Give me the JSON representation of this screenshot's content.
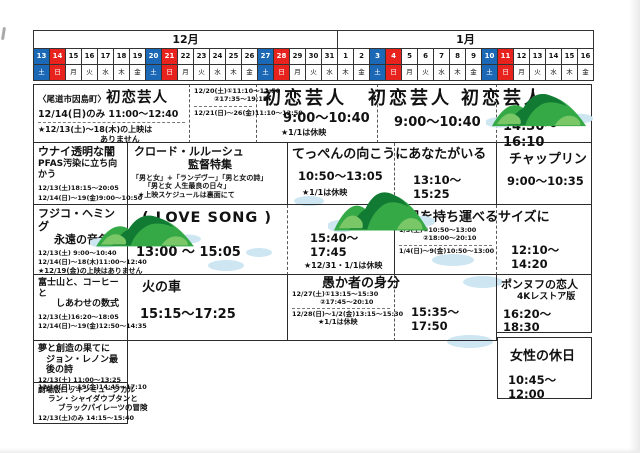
{
  "page": {
    "width": 640,
    "height": 453
  },
  "colors": {
    "saturday": "#1b69b6",
    "sunday": "#e8231d",
    "ink": "#111111",
    "grid_line": "#2b2b2b",
    "cloud": "#cde6f2",
    "island_green": "#35a946",
    "island_dark": "#117a33",
    "island_light": "#7ac768"
  },
  "calendar": {
    "months": [
      {
        "label": "12月",
        "days": 19
      },
      {
        "label": "1月",
        "days": 16
      }
    ],
    "days": [
      {
        "d": "13",
        "w": "土",
        "t": "sat"
      },
      {
        "d": "14",
        "w": "日",
        "t": "sun"
      },
      {
        "d": "15",
        "w": "月"
      },
      {
        "d": "16",
        "w": "火"
      },
      {
        "d": "17",
        "w": "水"
      },
      {
        "d": "18",
        "w": "木"
      },
      {
        "d": "19",
        "w": "金"
      },
      {
        "d": "20",
        "w": "土",
        "t": "sat"
      },
      {
        "d": "21",
        "w": "日",
        "t": "sun"
      },
      {
        "d": "22",
        "w": "月"
      },
      {
        "d": "23",
        "w": "火"
      },
      {
        "d": "24",
        "w": "水"
      },
      {
        "d": "25",
        "w": "木"
      },
      {
        "d": "26",
        "w": "金"
      },
      {
        "d": "27",
        "w": "土",
        "t": "sat"
      },
      {
        "d": "28",
        "w": "日",
        "t": "sun"
      },
      {
        "d": "29",
        "w": "月"
      },
      {
        "d": "30",
        "w": "火"
      },
      {
        "d": "31",
        "w": "水"
      },
      {
        "d": "1",
        "w": "木"
      },
      {
        "d": "2",
        "w": "金"
      },
      {
        "d": "3",
        "w": "土",
        "t": "sat"
      },
      {
        "d": "4",
        "w": "日",
        "t": "sun"
      },
      {
        "d": "5",
        "w": "月"
      },
      {
        "d": "6",
        "w": "火"
      },
      {
        "d": "7",
        "w": "水"
      },
      {
        "d": "8",
        "w": "木"
      },
      {
        "d": "9",
        "w": "金"
      },
      {
        "d": "10",
        "w": "土",
        "t": "sat"
      },
      {
        "d": "11",
        "w": "日",
        "t": "sun"
      },
      {
        "d": "12",
        "w": "月"
      },
      {
        "d": "13",
        "w": "火"
      },
      {
        "d": "14",
        "w": "水"
      },
      {
        "d": "15",
        "w": "木"
      },
      {
        "d": "16",
        "w": "金"
      }
    ]
  },
  "cells": [
    {
      "id": "cell-hatsukoi-onomichi",
      "x": 33,
      "y": 84,
      "w": 157,
      "h": 59,
      "b": "sdss",
      "lines": [
        {
          "parts": [
            {
              "t": "〈尾道市因島町〉",
              "cls": "ttl-xs"
            },
            {
              "t": "初恋芸人",
              "cls": "ttl-lg"
            }
          ]
        },
        {
          "t": "12/14(日)のみ 11:00～12:40",
          "cls": "time-sm",
          "mt": 2
        },
        {
          "div": 1,
          "mt": 2
        },
        {
          "t": "★12/13(土)～18(木)の上映は",
          "cls": "note",
          "mt": 2
        },
        {
          "t": "ありません",
          "cls": "note",
          "ml": 62
        }
      ]
    },
    {
      "id": "cell-hatsukoi-week2",
      "x": 190,
      "y": 84,
      "w": 67,
      "h": 59,
      "b": "sdsn",
      "lines": [
        {
          "t": "12/20(土)①11:10～12:50",
          "cls": "time-xxs"
        },
        {
          "t": "②17:35～19:15",
          "cls": "time-xxs",
          "ml": 20
        },
        {
          "div": 1,
          "mt": 3
        },
        {
          "t": "12/21(日)～26(金)11:10～12:50",
          "cls": "time-xxs",
          "mt": 3
        }
      ]
    },
    {
      "id": "cell-hatsukoi-week3",
      "x": 257,
      "y": 84,
      "w": 121,
      "h": 59,
      "b": "sdsn",
      "lines": [
        {
          "t": "初恋芸人",
          "cls": "ttl-xl",
          "ml": 2
        },
        {
          "t": "9:00～10:40",
          "cls": "time-lg",
          "ml": 22,
          "mt": 2
        },
        {
          "t": "★1/1は休映",
          "cls": "note",
          "ml": 20,
          "mt": 1
        }
      ]
    },
    {
      "id": "cell-hatsukoi-week4",
      "x": 378,
      "y": 84,
      "w": 119,
      "h": 59,
      "b": "sdsn",
      "lines": [
        {
          "t": "初恋芸人",
          "cls": "ttl-xl",
          "ml": -14,
          "nw": 1
        },
        {
          "t": "9:00～10:40",
          "cls": "time-lg",
          "ml": 12,
          "mt": 6
        }
      ]
    },
    {
      "id": "cell-hatsukoi-week5",
      "x": 497,
      "y": 84,
      "w": 95,
      "h": 59,
      "b": "sssn",
      "lines": [
        {
          "t": "初恋芸人",
          "cls": "ttl-xl",
          "ml": -40,
          "nw": 1
        },
        {
          "t": "14:30～16:10",
          "cls": "time-lg",
          "mt": 10,
          "ml": 2
        }
      ]
    },
    {
      "id": "cell-unai-pfas",
      "x": 33,
      "y": 143,
      "w": 95,
      "h": 62,
      "b": "nsss",
      "lines": [
        {
          "t": "ウナイ透明な闇",
          "cls": "ttl-sm"
        },
        {
          "t": "PFAS汚染に立ち向かう",
          "cls": "ttl-xs2"
        },
        {
          "t": "12/13(土)18:15～20:05",
          "cls": "time-xxs",
          "mt": 5
        },
        {
          "t": "12/14(日)～19(金)9:00～10:50",
          "cls": "time-xxs",
          "mt": 2
        }
      ]
    },
    {
      "id": "cell-lelouch-tokushu",
      "x": 128,
      "y": 143,
      "w": 160,
      "h": 62,
      "b": "nssn",
      "lines": [
        {
          "t": "クロード・ルルーシュ",
          "cls": "ttl-sm",
          "ml": 2
        },
        {
          "t": "監督特集",
          "cls": "ttl-sm",
          "ml": 56
        },
        {
          "t": "「男と女」+「ランデヴー」「男と女の詩」",
          "cls": "small",
          "mt": 2
        },
        {
          "t": "「男と女 人生最良の日々」",
          "cls": "small",
          "ml": 12
        },
        {
          "t": "★上映スケジュールは裏面にて",
          "cls": "small",
          "ml": 6,
          "mt": 1
        }
      ]
    },
    {
      "id": "cell-teppen-1",
      "x": 288,
      "y": 143,
      "w": 107,
      "h": 62,
      "b": "ndsn",
      "lines": [
        {
          "t": "てっぺんの向こうにあなたがいる",
          "cls": "ttl-md",
          "nw": 1,
          "mt": 1
        },
        {
          "t": "10:50～13:05",
          "cls": "time-md",
          "mt": 8,
          "ml": 6
        },
        {
          "t": "★1/1は休映",
          "cls": "note",
          "mt": 4,
          "ml": 10
        }
      ]
    },
    {
      "id": "cell-teppen-2",
      "x": 395,
      "y": 143,
      "w": 102,
      "h": 62,
      "b": "nssn",
      "lines": [
        {
          "t": "13:10～15:25",
          "cls": "time-md",
          "mt": 28,
          "ml": 14
        }
      ]
    },
    {
      "id": "cell-chaplin",
      "x": 497,
      "y": 143,
      "w": 95,
      "h": 62,
      "b": "nssn",
      "lines": [
        {
          "t": "チャップリン",
          "cls": "ttl-md",
          "mt": 6,
          "ml": 8
        },
        {
          "t": "9:00～10:35",
          "cls": "time-md",
          "mt": 8,
          "ml": 6
        }
      ]
    },
    {
      "id": "cell-fujiko-hemming",
      "x": 33,
      "y": 205,
      "w": 95,
      "h": 70,
      "b": "nsss",
      "lines": [
        {
          "t": "フジコ・ヘミング",
          "cls": "ttl-sm"
        },
        {
          "t": "永遠の音色",
          "cls": "ttl-sm",
          "ml": 16
        },
        {
          "t": "12/13(土) 9:00～10:40",
          "cls": "time-xxs",
          "mt": 3
        },
        {
          "t": "12/14(日)～18(木)11:00～12:40",
          "cls": "time-xxs",
          "mt": 1
        },
        {
          "t": "★12/19(金)の上映はありません",
          "cls": "small",
          "mt": 1
        }
      ]
    },
    {
      "id": "cell-lovesong-1",
      "x": 128,
      "y": 205,
      "w": 160,
      "h": 70,
      "b": "ndsn",
      "lines": [
        {
          "t": "( LOVE SONG )",
          "cls": "ttl-lg",
          "ml": 10,
          "mt": 2
        },
        {
          "t": "13:00 ～ 15:05",
          "cls": "time-lg",
          "mt": 18,
          "ml": 4
        }
      ]
    },
    {
      "id": "cell-lovesong-2",
      "x": 288,
      "y": 205,
      "w": 107,
      "h": 70,
      "b": "nssn",
      "lines": [
        {
          "t": "15:40～17:45",
          "cls": "time-md",
          "mt": 24,
          "ml": 18
        },
        {
          "t": "★12/31・1/1は休映",
          "cls": "note",
          "ml": 12,
          "mt": 2
        }
      ]
    },
    {
      "id": "cell-ani-size-1",
      "x": 395,
      "y": 205,
      "w": 102,
      "h": 70,
      "b": "ndsn",
      "lines": [
        {
          "t": "兄を持ち運べるサイズに",
          "cls": "ttl-md",
          "nw": 1,
          "mt": 2,
          "ml": 8
        },
        {
          "t": "1/3(土)①10:50～13:00",
          "cls": "time-xxs",
          "mt": 2
        },
        {
          "t": "②18:00～20:10",
          "cls": "time-xxs",
          "ml": 24
        },
        {
          "div": 1,
          "mt": 2
        },
        {
          "t": "1/4(日)～9(金)10:50～13:00",
          "cls": "time-xxs",
          "mt": 2
        }
      ]
    },
    {
      "id": "cell-ani-size-2",
      "x": 497,
      "y": 205,
      "w": 95,
      "h": 70,
      "b": "nssn",
      "lines": [
        {
          "t": "12:10～14:20",
          "cls": "time-md",
          "mt": 36,
          "ml": 10
        }
      ]
    },
    {
      "id": "cell-fujisan-coffee",
      "x": 33,
      "y": 275,
      "w": 95,
      "h": 66,
      "b": "nsss",
      "lines": [
        {
          "t": "富士山と、コーヒーと",
          "cls": "ttl-xs2"
        },
        {
          "t": "しあわせの数式",
          "cls": "ttl-xs2",
          "ml": 18
        },
        {
          "t": "12/13(土)16:20～18:05",
          "cls": "time-xxs",
          "mt": 4
        },
        {
          "t": "12/14(日)～19(金)12:50～14:35",
          "cls": "time-xxs",
          "mt": 2
        }
      ]
    },
    {
      "id": "cell-hinokuruma",
      "x": 128,
      "y": 275,
      "w": 160,
      "h": 66,
      "b": "nssn",
      "lines": [
        {
          "t": "火の車",
          "cls": "ttl-md",
          "ml": 10,
          "mt": 2
        },
        {
          "t": "15:15～17:25",
          "cls": "time-lg",
          "mt": 12,
          "ml": 8
        }
      ]
    },
    {
      "id": "cell-orokamono-1",
      "x": 288,
      "y": 275,
      "w": 107,
      "h": 66,
      "b": "ndsn",
      "lines": [
        {
          "t": "愚か者の身分",
          "cls": "ttl-md",
          "nw": 1,
          "ml": 30,
          "mt": -2
        },
        {
          "t": "12/27(土)①13:15～15:30",
          "cls": "time-xxs"
        },
        {
          "t": "②17:45～20:10",
          "cls": "time-xxs",
          "ml": 28
        },
        {
          "div": 1,
          "mt": 1
        },
        {
          "t": "12/28(日)～1/2(金)13:15～15:30",
          "cls": "time-xxs",
          "mt": 1
        },
        {
          "t": "★1/1は休映",
          "cls": "small",
          "ml": 26
        }
      ]
    },
    {
      "id": "cell-orokamono-2",
      "x": 395,
      "y": 275,
      "w": 102,
      "h": 66,
      "b": "nssn",
      "lines": [
        {
          "t": "15:35～17:50",
          "cls": "time-md",
          "mt": 28,
          "ml": 12
        }
      ]
    },
    {
      "id": "cell-pont-neuf",
      "x": 497,
      "y": 275,
      "w": 95,
      "h": 58,
      "b": "nssn",
      "lines": [
        {
          "t": "ポンヌフの恋人",
          "cls": "ttl-sm",
          "mt": 1
        },
        {
          "t": "4Kレストア版",
          "cls": "ttl-xs2",
          "ml": 16
        },
        {
          "t": "16:20～18:30",
          "cls": "time-md",
          "mt": 5,
          "ml": 2
        }
      ]
    },
    {
      "id": "cell-yume-john-lennon",
      "x": 33,
      "y": 341,
      "w": 95,
      "h": 42,
      "b": "nsss",
      "lines": [
        {
          "t": "夢と創造の果てに",
          "cls": "ttl-xs2"
        },
        {
          "t": "ジョン・レノン最後の詩",
          "cls": "ttl-xs2",
          "ml": 8
        },
        {
          "t": "12/13(土) 11:00～13:25",
          "cls": "time-xxs",
          "mt": 1
        },
        {
          "t": "12/14(日)～19(金)14:45～17:10",
          "cls": "time-xxs"
        }
      ]
    },
    {
      "id": "cell-rockin-musical",
      "x": 33,
      "y": 383,
      "w": 95,
      "h": 41,
      "b": "nsss",
      "lines": [
        {
          "t": "劇場版ロッキンミュージカル",
          "cls": "small-b"
        },
        {
          "t": "ラン・シャイダウブタンと",
          "cls": "small-b",
          "ml": 10
        },
        {
          "t": "ブラックパイレーツの冒険",
          "cls": "small-b",
          "ml": 20
        },
        {
          "t": "12/13(土)のみ 14:15～15:40",
          "cls": "time-xxs",
          "mt": 2
        }
      ]
    },
    {
      "id": "cell-josei-holiday",
      "x": 497,
      "y": 337,
      "w": 95,
      "h": 62,
      "b": "ssss",
      "lines": [
        {
          "t": "女性の休日",
          "cls": "ttl-md",
          "mt": 8,
          "ml": 8
        },
        {
          "t": "10:45～12:00",
          "cls": "time-md",
          "mt": 10,
          "ml": 6
        }
      ]
    }
  ],
  "decorations": {
    "islands": [
      {
        "x": 486,
        "y": 86,
        "w": 108,
        "h": 44
      },
      {
        "x": 328,
        "y": 183,
        "w": 108,
        "h": 52
      },
      {
        "x": 90,
        "y": 208,
        "w": 112,
        "h": 42
      }
    ],
    "clouds": [
      {
        "x": 294,
        "y": 196,
        "w": 30,
        "h": 10
      },
      {
        "x": 208,
        "y": 260,
        "w": 36,
        "h": 11
      },
      {
        "x": 246,
        "y": 248,
        "w": 26,
        "h": 9
      },
      {
        "x": 432,
        "y": 254,
        "w": 42,
        "h": 12
      },
      {
        "x": 463,
        "y": 276,
        "w": 40,
        "h": 12
      },
      {
        "x": 447,
        "y": 335,
        "w": 46,
        "h": 13
      }
    ]
  }
}
